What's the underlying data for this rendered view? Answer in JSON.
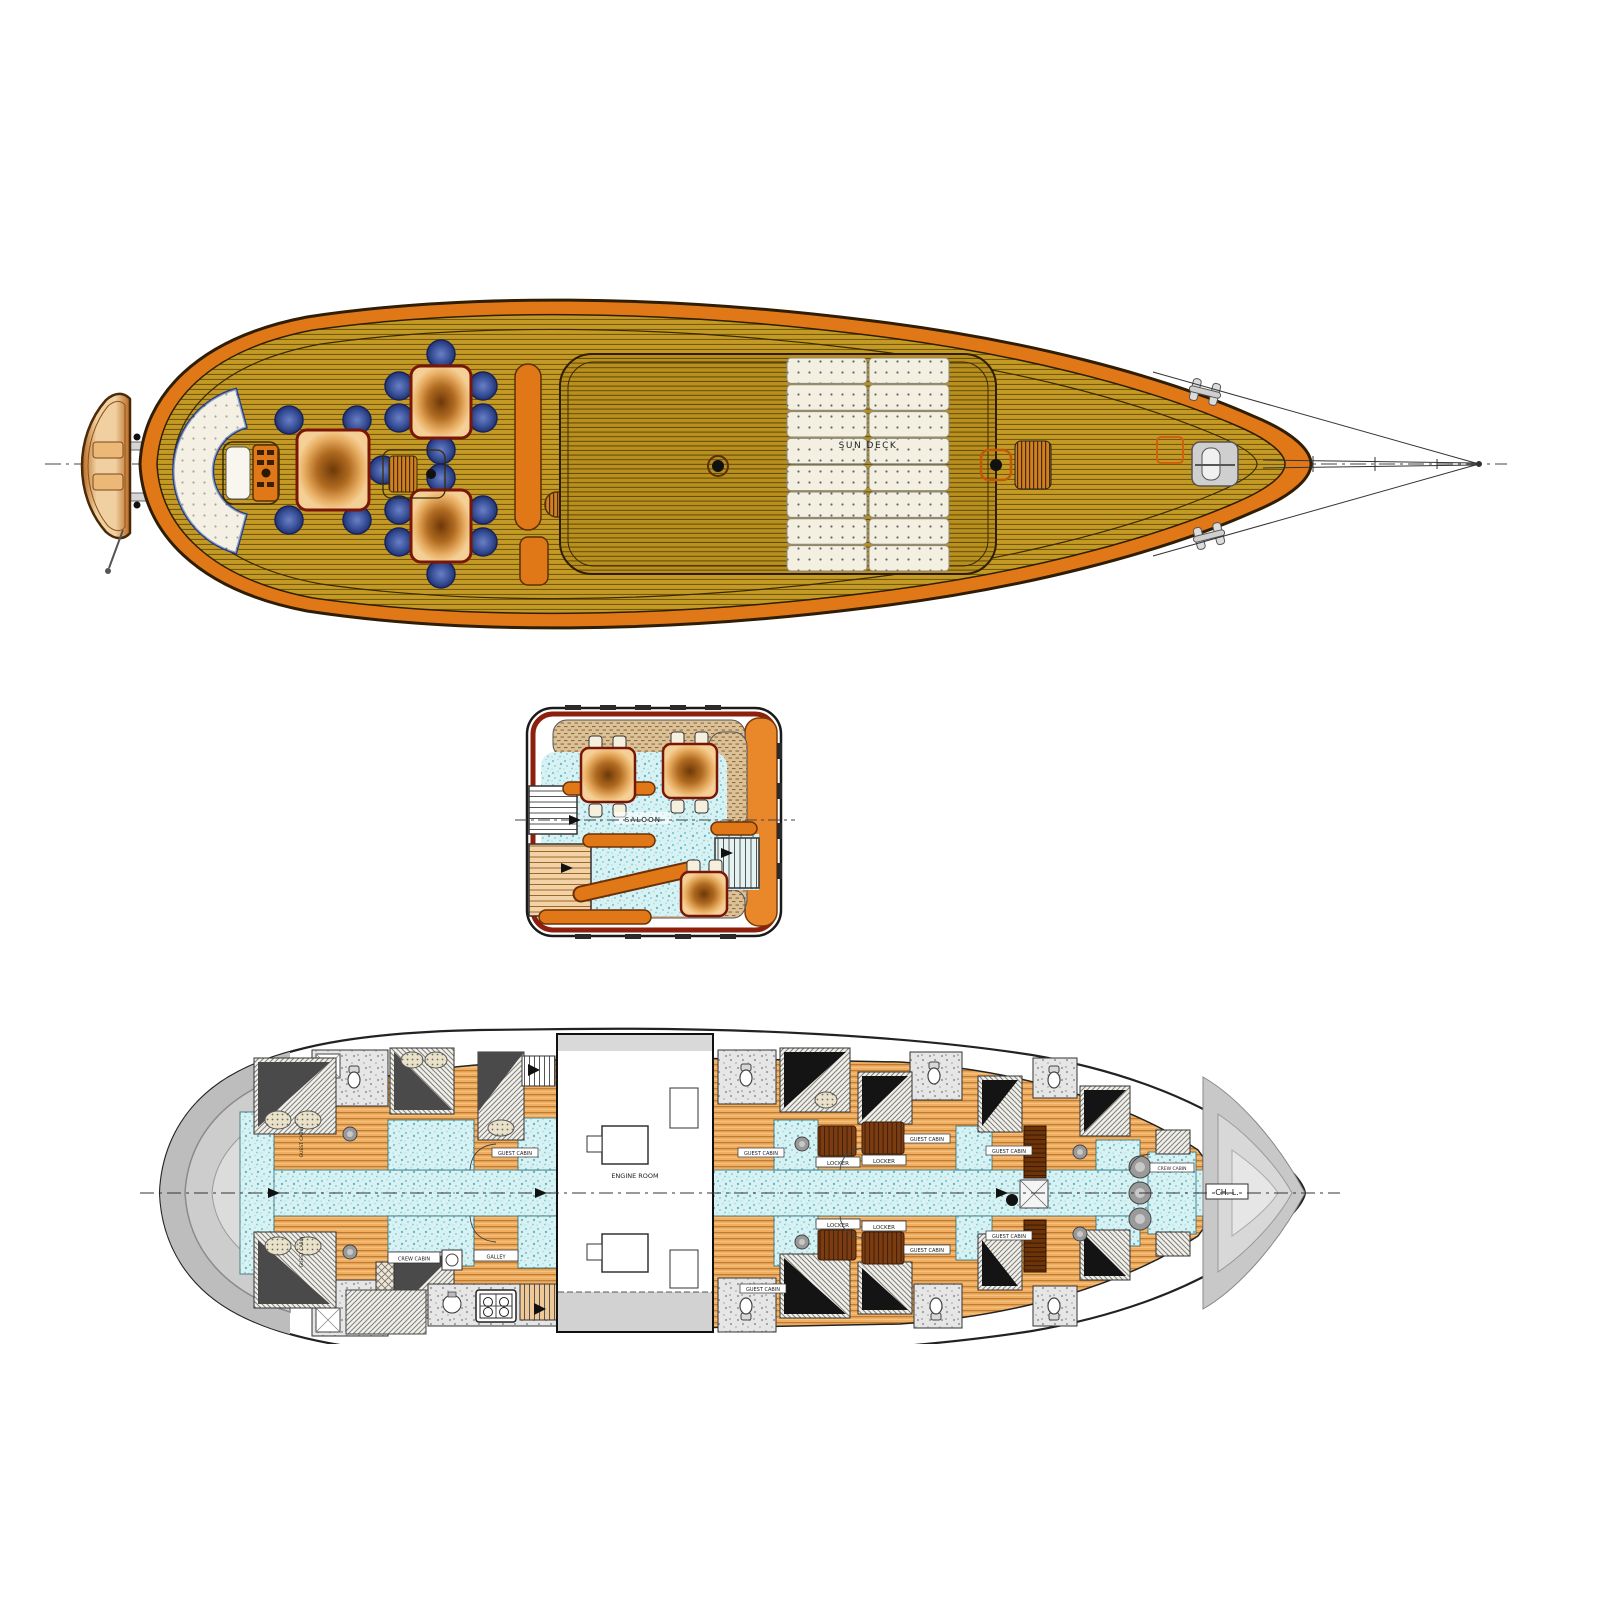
{
  "labels": {
    "sun_deck": "SUN DECK",
    "saloon": "SALOON",
    "engine_room": "ENGINE ROOM",
    "guest_cabin": "GUEST CABIN",
    "crew_cabin": "CREW CABIN",
    "locker": "LOCKER",
    "galley": "GALLEY",
    "chain_locker": "CH. L."
  },
  "colors": {
    "deck_plank": "#c49a24",
    "plank_line": "#6b5608",
    "rail_orange": "#e07818",
    "hull_outline": "#2f1e04",
    "chair_blue": "#44589f",
    "cushion_white": "#f3f0e2",
    "saloon_floor": "#d8f2f4",
    "wicker_tan": "#dcc096",
    "maroon_trim": "#8c200c",
    "cabin_wood": "#efae62",
    "corridor_blue": "#cceef2",
    "bathroom_gray": "#e4e4e4",
    "locker_brown": "#7a3c10",
    "hull_gray": "#c6c6c6",
    "table_wood": "#8a4a14"
  }
}
